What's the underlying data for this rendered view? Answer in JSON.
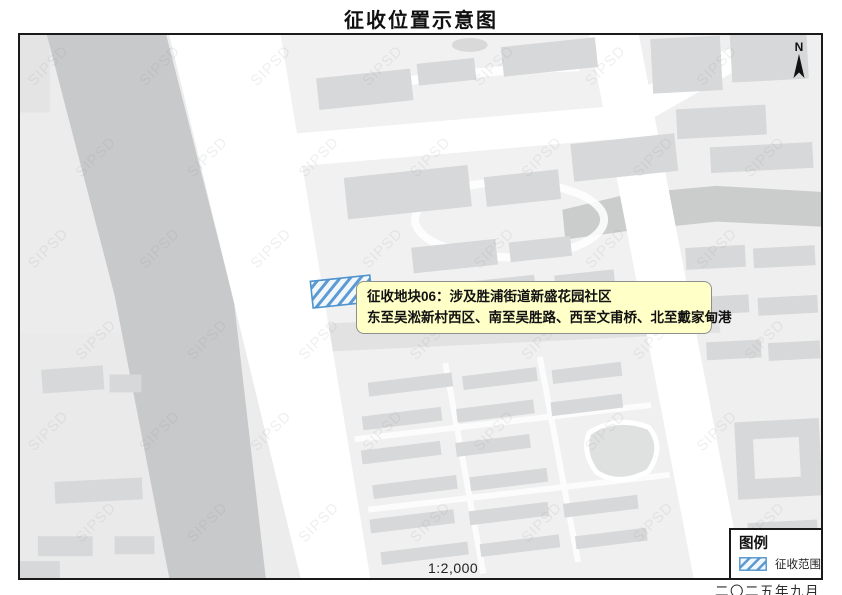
{
  "title": "征收位置示意图",
  "map": {
    "watermark": "SIPSD",
    "north_label": "N",
    "scale_text": "1:2,000",
    "callout": {
      "line1": "征收地块06：涉及胜浦街道新盛花园社区",
      "line2": "东至吴淞新村西区、南至吴胜路、西至文甫桥、北至戴家甸港",
      "bg_color": "#FFFFC8",
      "border_color": "#8F8F8F"
    },
    "parcel": {
      "meaning": "征收范围",
      "hatch_color": "#4F93CE",
      "fill_color": "#F2F7FC"
    }
  },
  "legend": {
    "title": "图例",
    "items": [
      {
        "label": "征收范围",
        "swatch": "blue-diagonal-hatch"
      }
    ]
  },
  "footer": {
    "date_text": "二〇二五年九月"
  },
  "colors": {
    "map_background": "#ECECEC",
    "road": "#FFFFFF",
    "river": "#C8C9CA",
    "building": "#D7D8D9",
    "frame_border": "#1A1A1A"
  }
}
